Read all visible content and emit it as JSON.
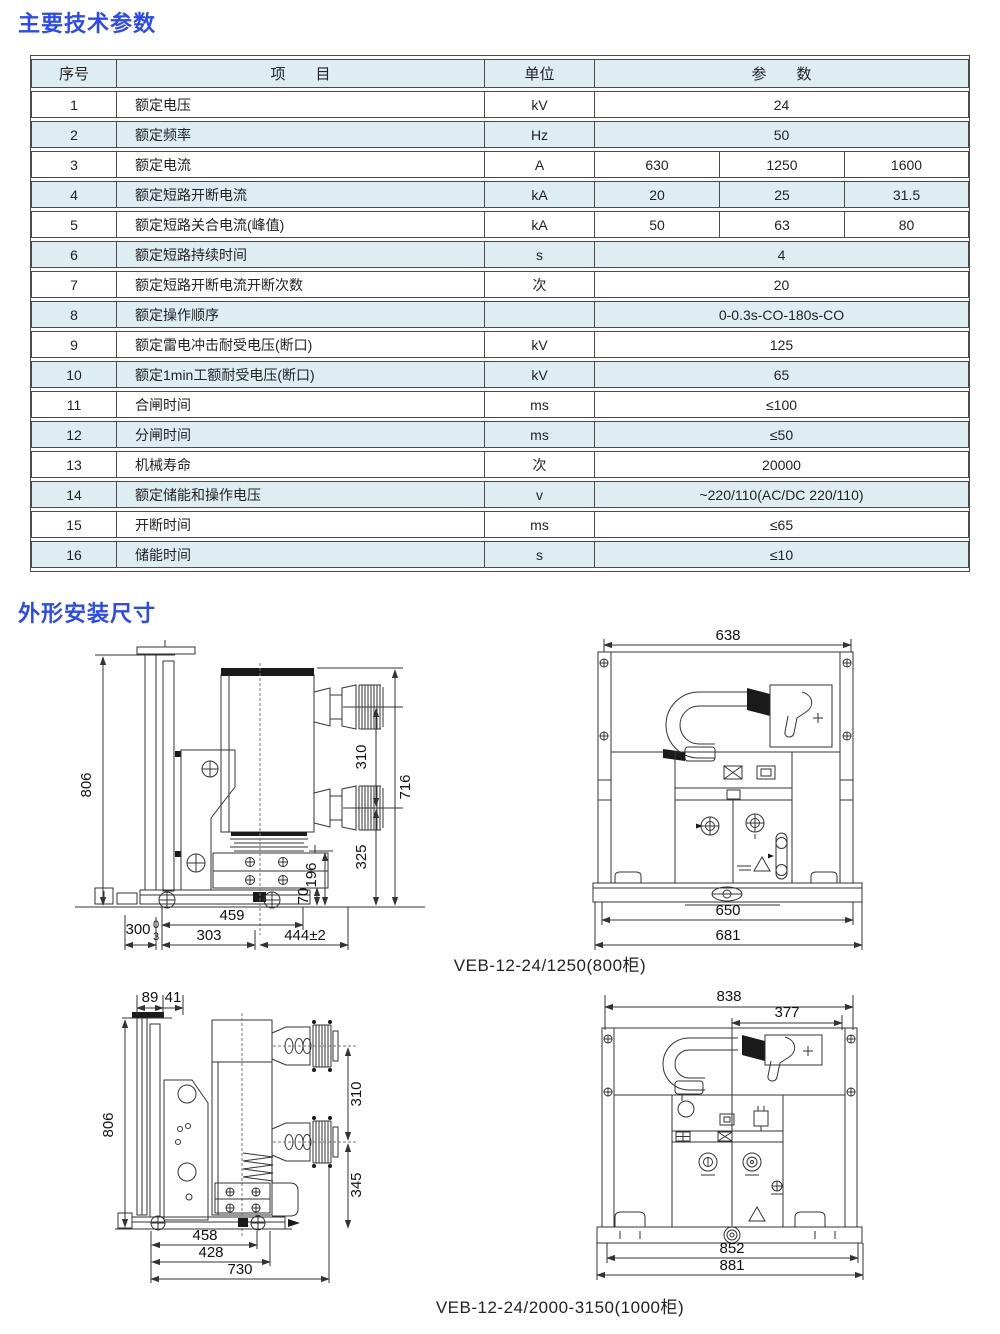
{
  "titles": {
    "section1": "主要技术参数",
    "section2": "外形安装尺寸"
  },
  "table": {
    "headers": {
      "no": "序号",
      "item": "项　　目",
      "unit": "单位",
      "param": "参　　数"
    },
    "rows": [
      {
        "no": "1",
        "item": "额定电压",
        "unit": "kV",
        "value": "24"
      },
      {
        "no": "2",
        "item": "额定频率",
        "unit": "Hz",
        "value": "50"
      },
      {
        "no": "3",
        "item": "额定电流",
        "unit": "A",
        "values": [
          "630",
          "1250",
          "1600"
        ]
      },
      {
        "no": "4",
        "item": "额定短路开断电流",
        "unit": "kA",
        "values": [
          "20",
          "25",
          "31.5"
        ]
      },
      {
        "no": "5",
        "item": "额定短路关合电流(峰值)",
        "unit": "kA",
        "values": [
          "50",
          "63",
          "80"
        ]
      },
      {
        "no": "6",
        "item": "额定短路持续时间",
        "unit": "s",
        "value": "4"
      },
      {
        "no": "7",
        "item": "额定短路开断电流开断次数",
        "unit": "次",
        "value": "20"
      },
      {
        "no": "8",
        "item": "额定操作顺序",
        "unit": "",
        "value": "0-0.3s-CO-180s-CO"
      },
      {
        "no": "9",
        "item": "额定雷电冲击耐受电压(断口)",
        "unit": "kV",
        "value": "125"
      },
      {
        "no": "10",
        "item": "额定1min工额耐受电压(断口)",
        "unit": "kV",
        "value": "65"
      },
      {
        "no": "11",
        "item": "合闸时间",
        "unit": "ms",
        "value": "≤100"
      },
      {
        "no": "12",
        "item": "分闸时间",
        "unit": "ms",
        "value": "≤50"
      },
      {
        "no": "13",
        "item": "机械寿命",
        "unit": "次",
        "value": "20000"
      },
      {
        "no": "14",
        "item": "额定储能和操作电压",
        "unit": "v",
        "value": "~220/110(AC/DC 220/110)"
      },
      {
        "no": "15",
        "item": "开断时间",
        "unit": "ms",
        "value": "≤65"
      },
      {
        "no": "16",
        "item": "储能时间",
        "unit": "s",
        "value": "≤10"
      }
    ]
  },
  "drawings": {
    "caption_800": "VEB-12-24/1250(800柜)",
    "caption_1000": "VEB-12-24/2000-3150(1000柜)",
    "side_800": {
      "height_total": "806",
      "pole_pitch": "310",
      "frame_height": "716",
      "lower_height": "325",
      "base_height": "196",
      "rail_height": "70",
      "len_459": "459",
      "len_303": "303",
      "len_444": "444±2",
      "len_300": "300",
      "tol_hi": "0",
      "tol_lo": "3"
    },
    "front_800": {
      "top_width": "638",
      "inner_width": "650",
      "outer_width": "681"
    },
    "side_1000": {
      "len_89": "89",
      "len_41": "41",
      "height_total": "806",
      "pole_pitch": "310",
      "lower_height": "345",
      "len_458": "458",
      "len_428": "428",
      "len_730": "730"
    },
    "front_1000": {
      "top_width": "838",
      "inner_top_width": "377",
      "inner_width": "852",
      "outer_width": "881"
    }
  },
  "colors": {
    "accent_blue": "#2b4af0",
    "row_tint": "#ddedf2",
    "line": "#333333"
  }
}
